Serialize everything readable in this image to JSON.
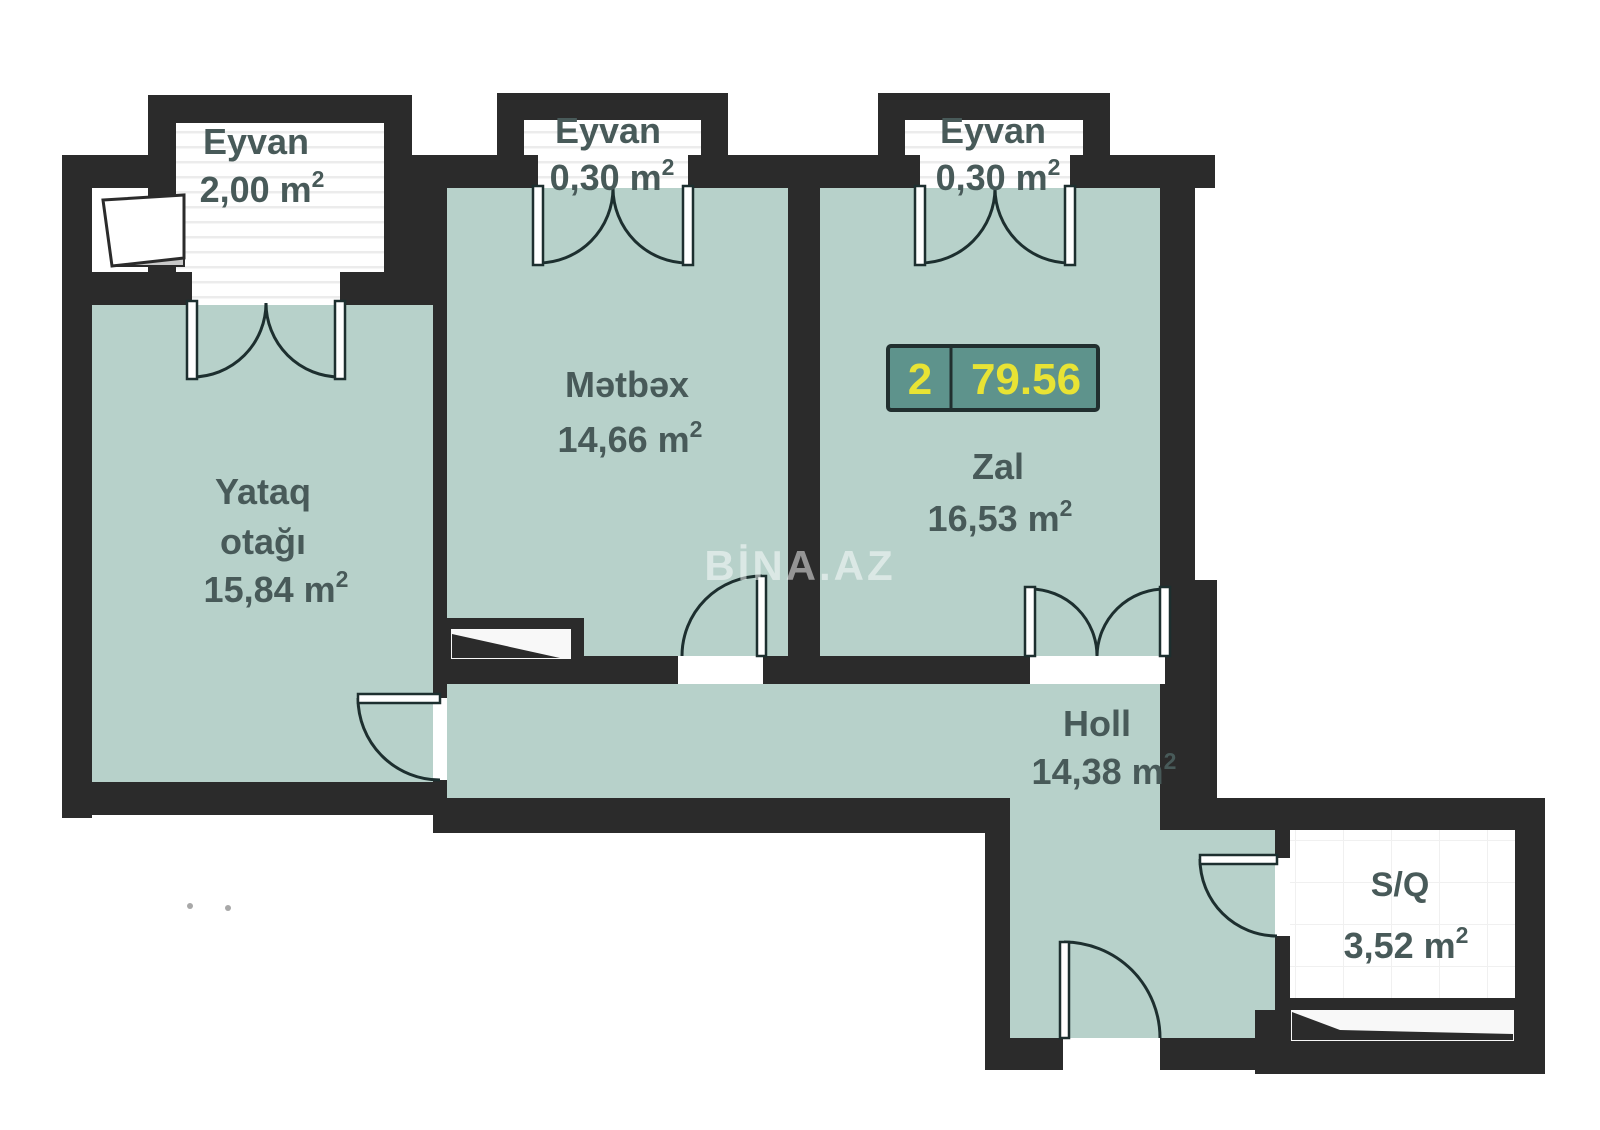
{
  "plan": {
    "watermark": "BİNA.AZ",
    "badge": {
      "rooms": "2",
      "area": "79.56"
    },
    "rooms": {
      "balcony1": {
        "name": "Eyvan",
        "area": "2,00 m",
        "sup": "2"
      },
      "balcony2": {
        "name": "Eyvan",
        "area": "0,30 m",
        "sup": "2"
      },
      "balcony3": {
        "name": "Eyvan",
        "area": "0,30 m",
        "sup": "2"
      },
      "bedroom": {
        "name_line1": "Yataq",
        "name_line2": "otağı",
        "area": "15,84 m",
        "sup": "2"
      },
      "kitchen": {
        "name": "Mətbəx",
        "area": "14,66 m",
        "sup": "2"
      },
      "living": {
        "name": "Zal",
        "area": "16,53 m",
        "sup": "2"
      },
      "hall": {
        "name": "Holl",
        "area": "14,38 m",
        "sup": "2"
      },
      "bathroom": {
        "name": "S/Q",
        "area": "3,52 m",
        "sup": "2"
      }
    },
    "colors": {
      "wall": "#2b2b2b",
      "floor": "#b7d1ca",
      "label": "#485a59",
      "badge_bg": "#5e938c",
      "badge_text": "#e8e334",
      "door": "#1d2f2f"
    }
  }
}
